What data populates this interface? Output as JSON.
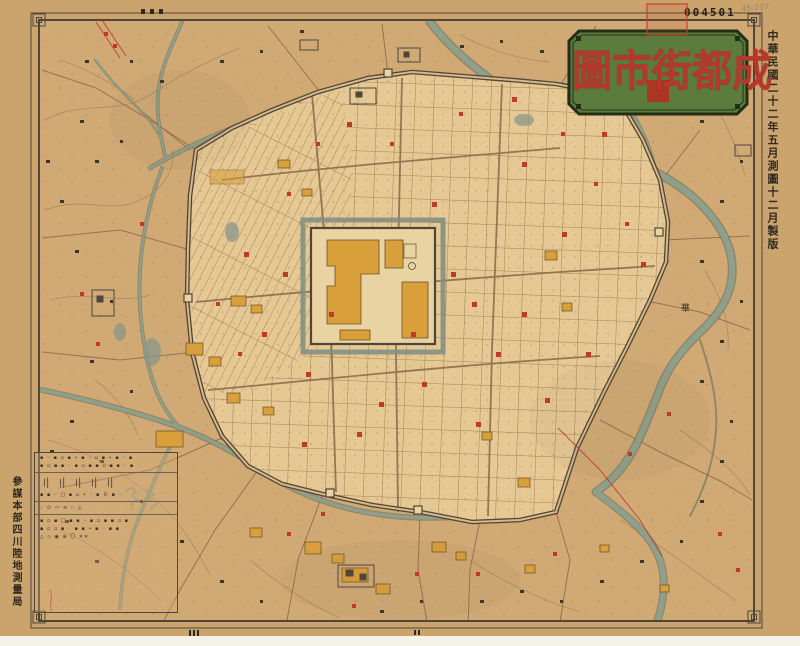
{
  "title": {
    "text": "成都街市圖",
    "display_chars": [
      "圖",
      "市",
      "街",
      "都",
      "成"
    ]
  },
  "header": {
    "serial": "004501",
    "pencil_note": "45-107"
  },
  "margin_right": {
    "text": "中華民國二十二年五月測圖十二月製版"
  },
  "margin_left": {
    "text": "參謀本部四川陸地測量局"
  },
  "map_labels": {
    "county_east": "華"
  },
  "legend": {
    "rows": [
      "▪ ◦ ▪ ▫ ▪ ∙ ▪ ◦ ▫ ▪ ∙ ▪ ◦ ▪",
      "▪ ▫ ▪ ▪ ◦ ▪ ▫ ▪ ▪ ▫ ▪ ▪ ◦ ▪",
      "〢〢〢〢〢",
      "▪ ▪ ◦ □ ▪ ▫ ∙ ◦ ▪ 〥 ▪ ◦",
      "∴ ⊙ 〰 ≋ ∷ ◬",
      "▪ ▫ ▪ □ ▪ ▪ ◦ ▪ ▫ ▪ ▪ ▫ ▪",
      "▪ ▫ ▫ ▪ ◦ ▪ ▪ ∙ ▪ ◦ ▪ ▪",
      "△ ⬦ ◉ ⊕ 〇 ✕✕"
    ]
  },
  "colors": {
    "paper": "#cba36d",
    "city_block": "#e5c894",
    "street": "#a5825a",
    "river": "#8ea08b",
    "wall": "#4e463a",
    "building_orange": "#d99f3b",
    "mark_red": "#bf3a2b",
    "plaque_green": "#5c7c3e",
    "title_red": "#b5382c"
  }
}
